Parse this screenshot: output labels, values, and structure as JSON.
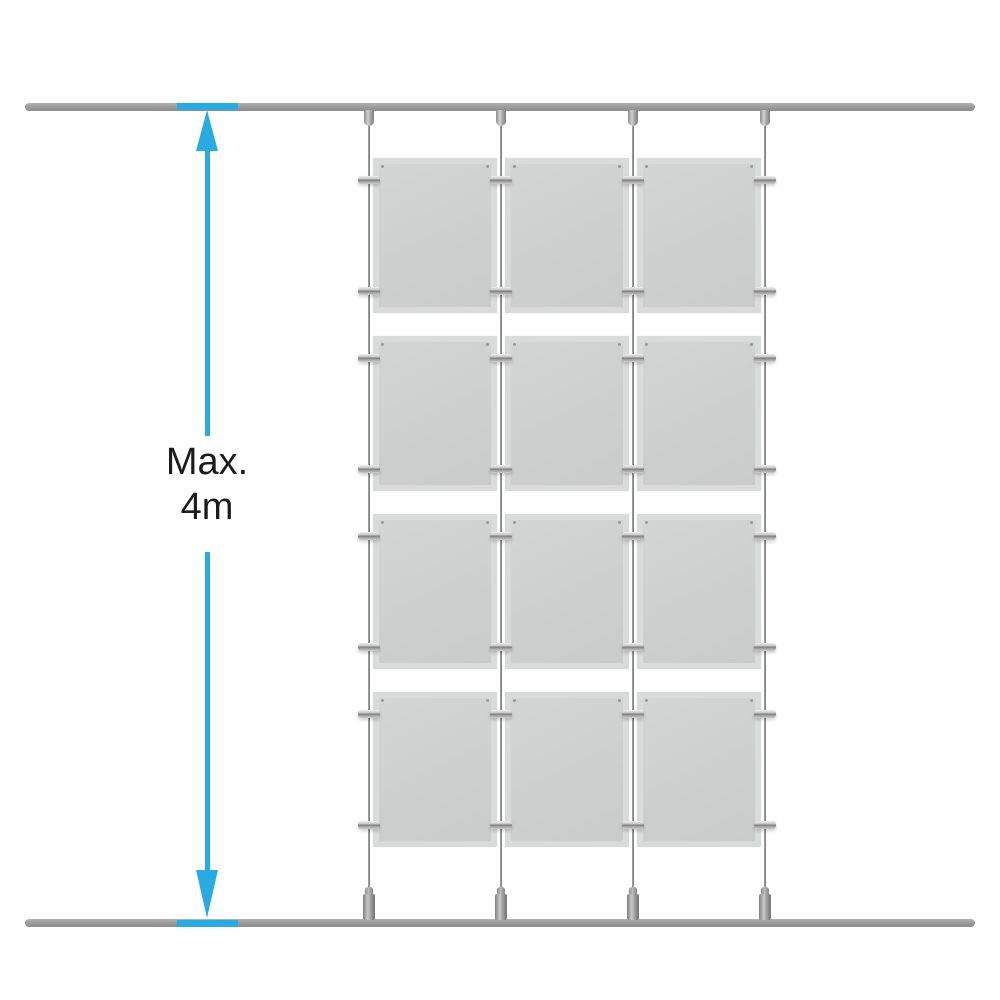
{
  "diagram": {
    "description": "Ceiling-to-floor cable display system, 3 columns x 4 rows of poster pockets suspended on 4 cables between two horizontal tracks",
    "annotation": {
      "line1": "Max.",
      "line2": "4m"
    },
    "grid": {
      "columns": 3,
      "rows": 4,
      "cables": 4,
      "panels": 12
    },
    "colors": {
      "dimension": "#29ABE2",
      "track": "#9a9a9a",
      "panel": "#cecfcf",
      "panel_border": "#d9dada",
      "cable": "#8b8b8b",
      "text": "#1c1c1c",
      "background": "#ffffff"
    }
  }
}
